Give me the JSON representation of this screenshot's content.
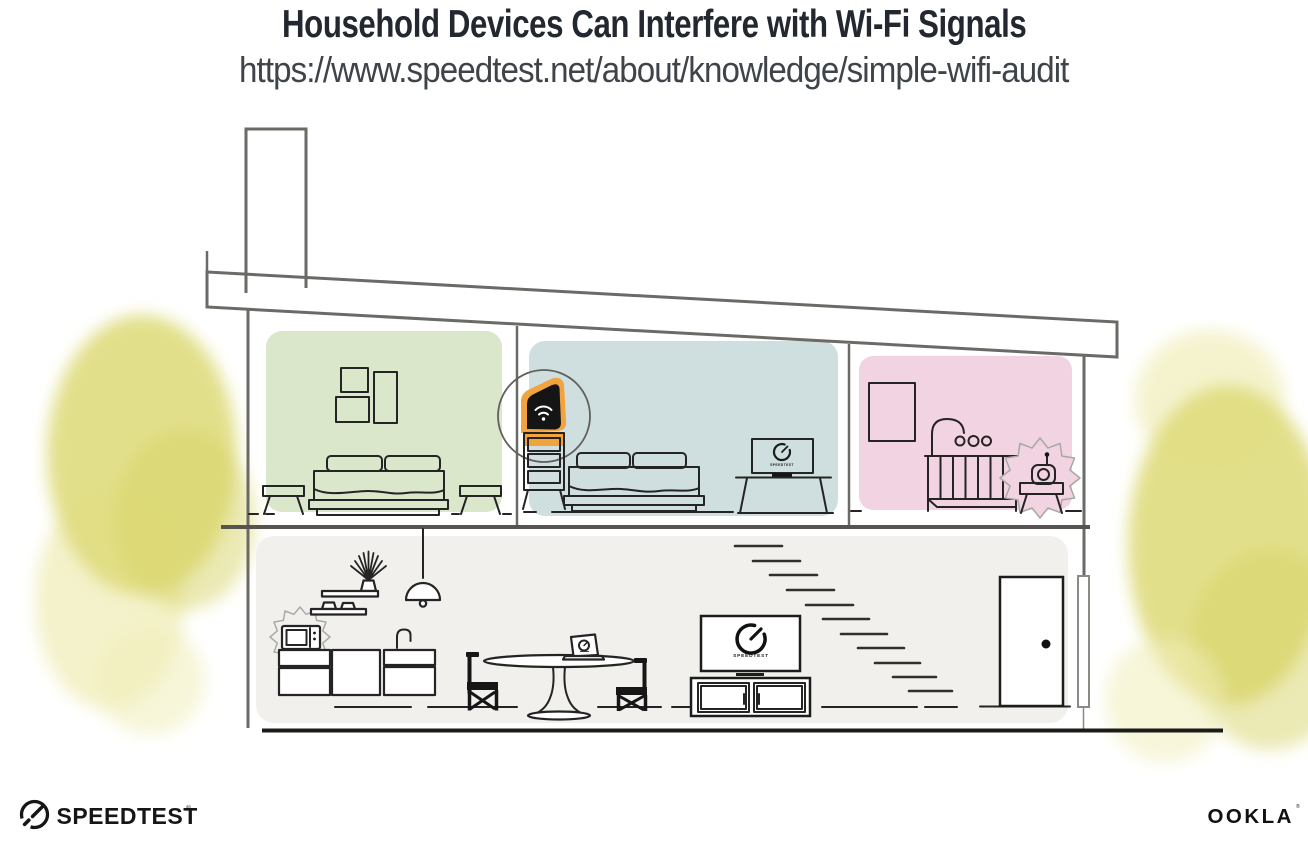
{
  "header": {
    "title": "Household Devices Can Interfere with Wi-Fi Signals",
    "url": "https://www.speedtest.net/about/knowledge/simple-wifi-audit"
  },
  "illustration": {
    "labels": {
      "tv_screen": "SPEEDTEST",
      "bedroom_monitor": "SPEEDTEST"
    },
    "colors": {
      "bedroom_green_wall": "#dbe7cb",
      "bedroom_blue_wall": "#cfdfe0",
      "nursery_pink_wall": "#f2d3e2",
      "ground_floor_wall": "#f1f0ed",
      "foliage_yellow": "#dfdc7d",
      "router_highlight": "#f1a33e"
    }
  },
  "footer": {
    "speedtest_wordmark": "SPEEDTEST",
    "speedtest_registered": "®",
    "ookla_wordmark": "OOKLA",
    "ookla_registered": "®"
  }
}
